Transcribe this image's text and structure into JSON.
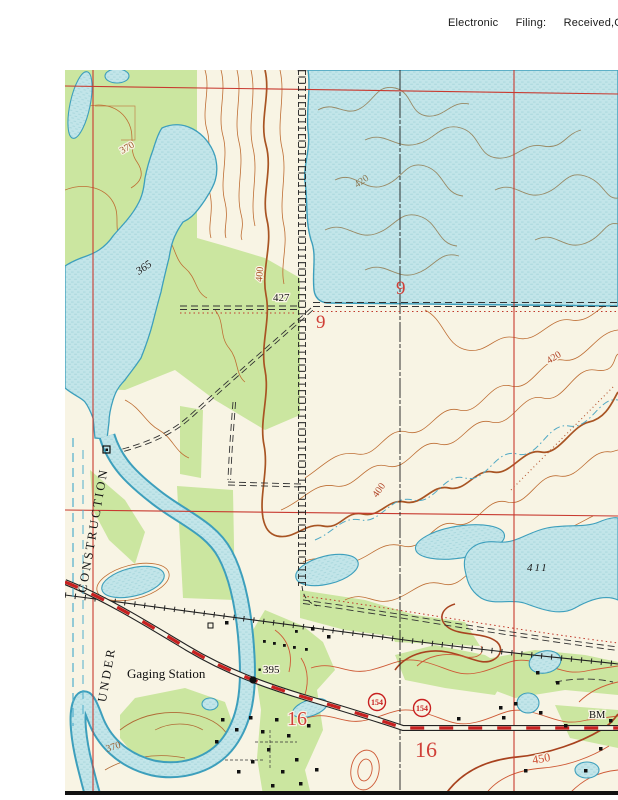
{
  "header": {
    "text_parts": [
      "Electronic",
      "Filing:",
      "Received,Cl"
    ]
  },
  "colors": {
    "map_background": "#F8F4E4",
    "woodland_green": "#CBE6A0",
    "water_fill": "#C2E5E9",
    "water_outline": "#3D9FBC",
    "contour_brown": "#BE6E34",
    "contour_index_brown": "#A85423",
    "contour_red": "#CE5A36",
    "grid_red": "#C83A30",
    "label_red": "#D04038",
    "ink_black": "#1C1C1C"
  },
  "map": {
    "labels": {
      "contour_370_nw": "370",
      "water_365": "365",
      "contour_420_lake": "420",
      "spot_427": "427",
      "section_9_lake": "9",
      "section_9_west": "9",
      "contour_400_west": "400",
      "contour_420_east": "420",
      "contour_400_center": "400",
      "pond_411": "411",
      "under_construction_line1": "UNDER",
      "under_construction_line2": "CONSTRUCTION",
      "gaging_station": "Gaging Station",
      "spot_395": "395",
      "route_marker_west": "154",
      "route_marker_east": "154",
      "section_16_west": "16",
      "section_16_east": "16",
      "benchmark": "BM",
      "contour_450": "450",
      "contour_370_sw": "370"
    }
  }
}
